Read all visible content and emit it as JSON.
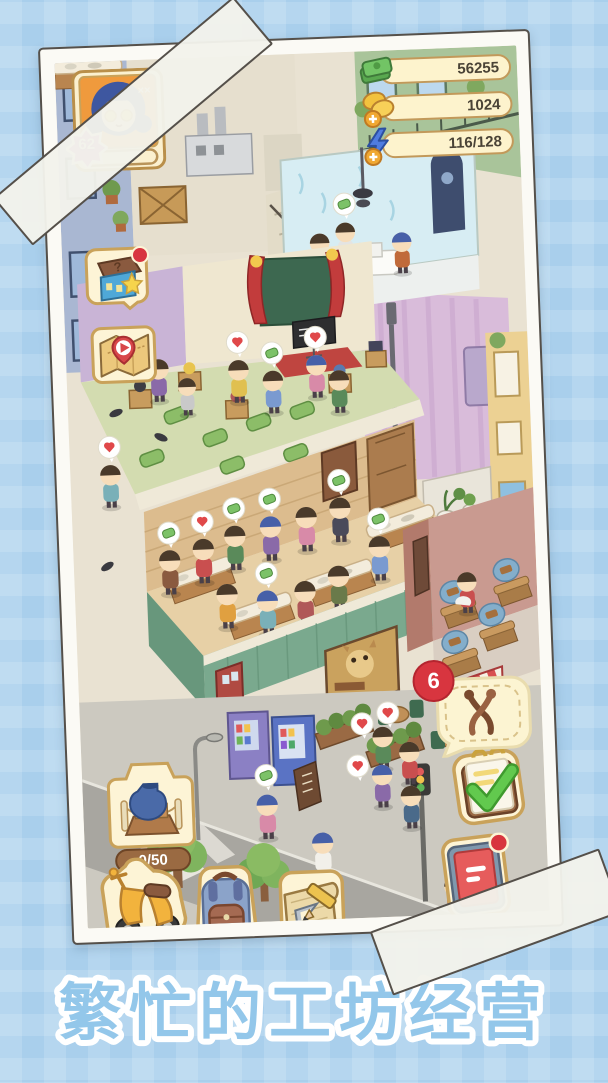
{
  "window": {
    "caption": "繁忙的工坊经营"
  },
  "hud": {
    "player": {
      "level": "62",
      "avatar_icon": "girl-blue-hair-star-glasses"
    },
    "currencies": [
      {
        "name": "cash",
        "icon": "cash-icon",
        "value": "56255"
      },
      {
        "name": "coins",
        "icon": "coin-plus-icon",
        "value": "1024"
      },
      {
        "name": "energy",
        "icon": "energy-plus-icon",
        "value": "116/128"
      }
    ],
    "left_buttons": [
      {
        "name": "mystery-box",
        "icon": "gift-box-icon",
        "has_notification": true
      },
      {
        "name": "map",
        "icon": "map-play-icon",
        "has_notification": false
      }
    ],
    "exhibit": {
      "icon": "vase-pedestal-icon",
      "count": "0/50"
    },
    "bottom_buttons": [
      {
        "name": "scooter",
        "icon": "scooter-icon"
      },
      {
        "name": "backpack",
        "icon": "backpack-icon"
      },
      {
        "name": "blueprint",
        "icon": "blueprint-pencil-icon"
      }
    ],
    "right_buttons": [
      {
        "name": "tasks",
        "icon": "clipboard-check-icon",
        "has_notification": false
      },
      {
        "name": "journal",
        "icon": "journal-icon",
        "has_notification": true
      }
    ],
    "order_bubble": {
      "icon": "pliers-icon",
      "badge": "6"
    },
    "speech_bubble_icons": [
      "heart-icon",
      "cash-icon",
      "item-icon"
    ]
  }
}
